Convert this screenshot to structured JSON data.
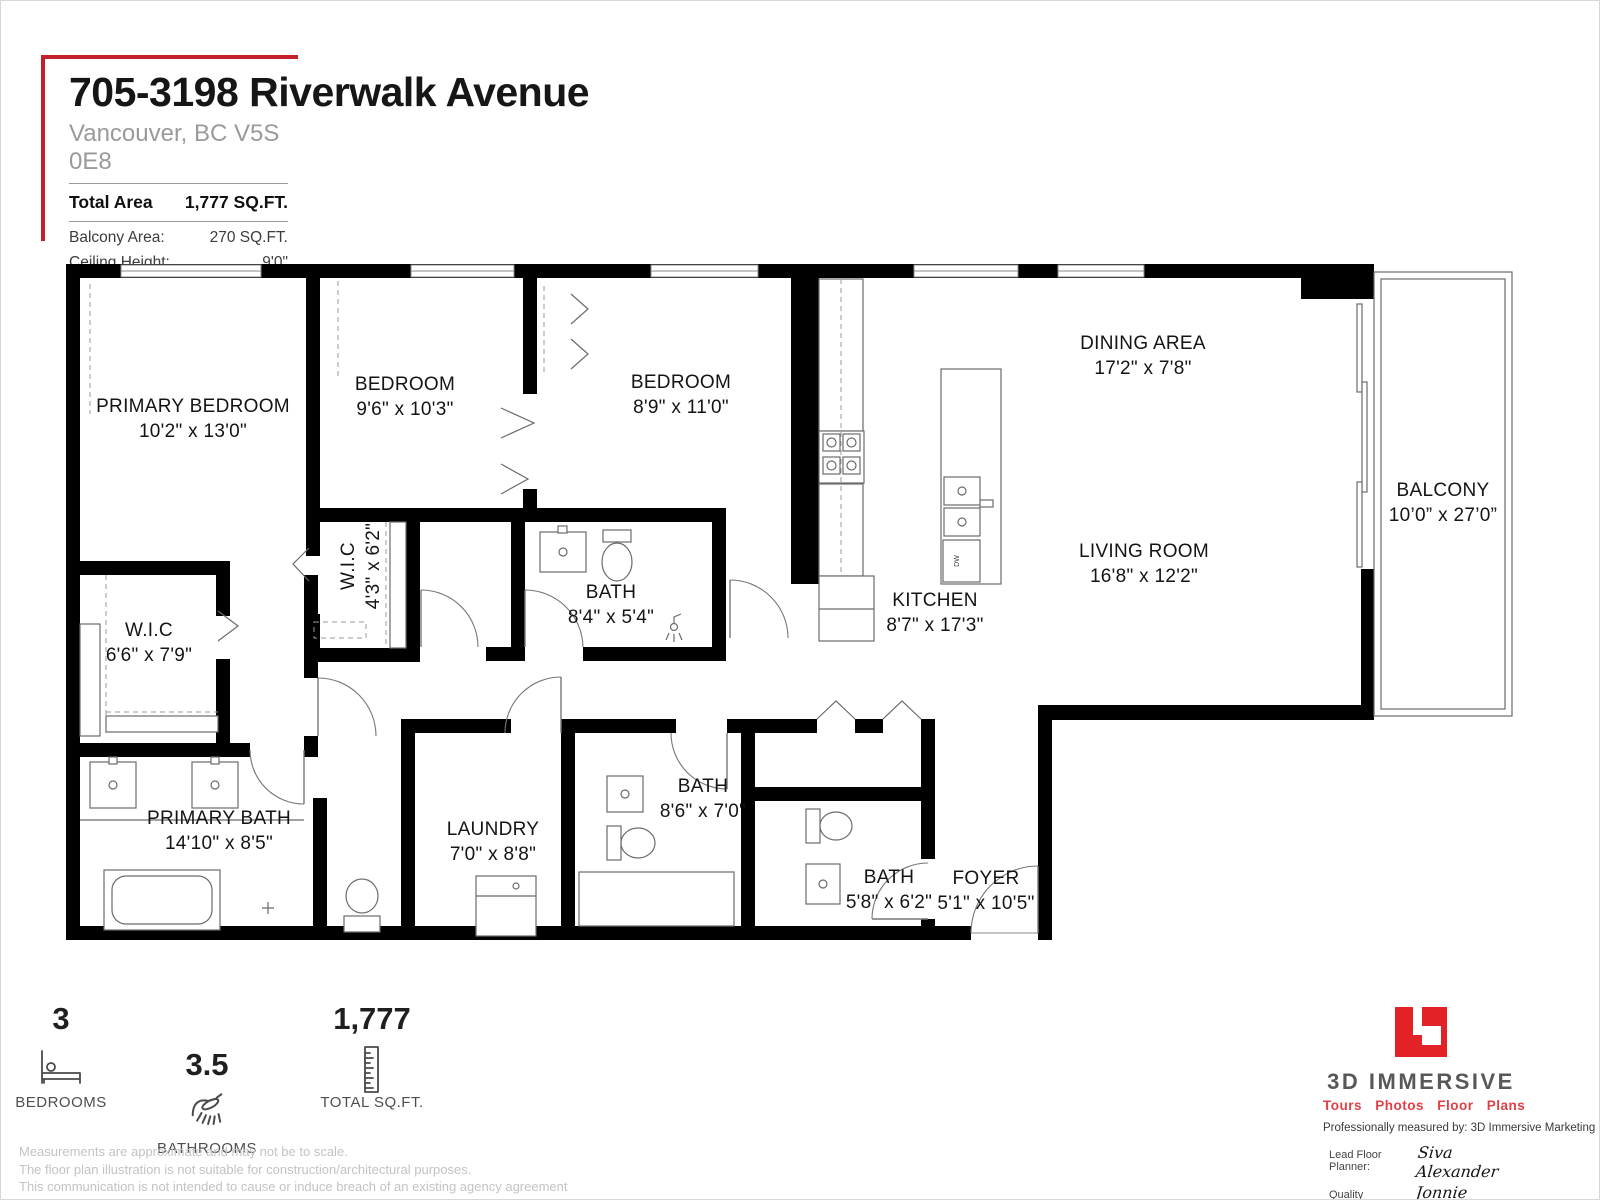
{
  "header": {
    "title": "705-3198 Riverwalk Avenue",
    "subtitle": "Vancouver, BC V5S 0E8",
    "total_area_label": "Total Area",
    "total_area_value": "1,777 SQ.FT.",
    "balcony_area_label": "Balcony Area:",
    "balcony_area_value": "270 SQ.FT.",
    "ceiling_height_label": "Ceiling Height:",
    "ceiling_height_value": "9'0\""
  },
  "plan": {
    "rooms": [
      {
        "name": "PRIMARY BEDROOM",
        "dims": "10'2\" x 13'0\"",
        "x": 127,
        "y": 148
      },
      {
        "name": "BEDROOM",
        "dims": "9'6\" x 10'3\"",
        "x": 339,
        "y": 126
      },
      {
        "name": "BEDROOM",
        "dims": "8'9\" x 11'0\"",
        "x": 615,
        "y": 124
      },
      {
        "name": "W.I.C",
        "dims": "4'3\" x 6'2\"",
        "x": 288,
        "y": 302,
        "rotate": true
      },
      {
        "name": "W.I.C",
        "dims": "6'6\" x 7'9\"",
        "x": 83,
        "y": 372
      },
      {
        "name": "BATH",
        "dims": "8'4\" x 5'4\"",
        "x": 545,
        "y": 334
      },
      {
        "name": "KITCHEN",
        "dims": "8'7\" x 17'3\"",
        "x": 869,
        "y": 342
      },
      {
        "name": "DINING AREA",
        "dims": "17'2\" x 7'8\"",
        "x": 1077,
        "y": 85
      },
      {
        "name": "LIVING ROOM",
        "dims": "16'8\" x 12'2\"",
        "x": 1078,
        "y": 293
      },
      {
        "name": "BALCONY",
        "dims": "10’0” x 27’0”",
        "x": 1377,
        "y": 232
      },
      {
        "name": "PRIMARY BATH",
        "dims": "14'10\" x 8'5\"",
        "x": 153,
        "y": 560
      },
      {
        "name": "LAUNDRY",
        "dims": "7'0\" x 8'8\"",
        "x": 427,
        "y": 571
      },
      {
        "name": "BATH",
        "dims": "8'6\" x 7'0\"",
        "x": 637,
        "y": 528
      },
      {
        "name": "BATH",
        "dims": "5'8\" x 6'2\"",
        "x": 823,
        "y": 619
      },
      {
        "name": "FOYER",
        "dims": "5'1\" x 10'5\"",
        "x": 920,
        "y": 620
      }
    ],
    "dishwasher_label": "DW"
  },
  "stats": [
    {
      "value": "3",
      "label": "BEDROOMS",
      "icon": "bed-icon"
    },
    {
      "value": "3.5",
      "label": "BATHROOMS",
      "icon": "shower-icon"
    },
    {
      "value": "1,777",
      "label": "TOTAL SQ.FT.",
      "icon": "ruler-icon"
    }
  ],
  "disclaimer": [
    "Measurements are approximate and may not be to scale.",
    "The floor plan illustration is not suitable for construction/architectural purposes.",
    "This communication is not intended to cause or induce breach of an existing agency agreement"
  ],
  "branding": {
    "company": "3D IMMERSIVE",
    "tagline": "Tours Photos Floor Plans",
    "measured_by": "Professionally measured by: 3D Immersive Marketing Ltd.",
    "planner_label": "Lead Floor Planner:",
    "planner_name": "Siva Alexander",
    "qa_label": "Quality Assurance:",
    "qa_name": "Jonnie Graham"
  },
  "colors": {
    "accent_red": "#c3202a",
    "logo_red": "#e32227",
    "wall_black": "#000000"
  }
}
